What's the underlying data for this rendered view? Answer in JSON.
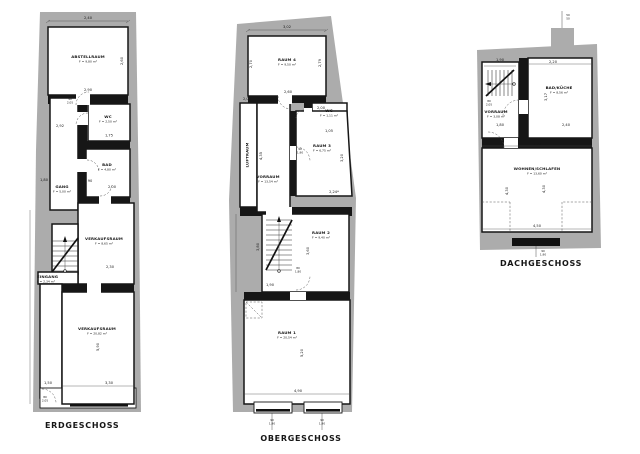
{
  "colors": {
    "wall_gray": "#acacac",
    "ink": "#161616",
    "background": "#ffffff"
  },
  "plans": {
    "eg": {
      "title": "ERDGESCHOSS",
      "rooms": {
        "abstellraum": {
          "name": "ABSTELLRAUM",
          "area": "F = 9,80 m²"
        },
        "wc": {
          "name": "WC",
          "area": "F = 2,50 m²"
        },
        "bad": {
          "name": "BAD",
          "area": "F = 4,80 m²"
        },
        "gang": {
          "name": "GANG",
          "area": "F = 5,00 m²"
        },
        "verkaufsraum_klein": {
          "name": "VERKAUFSRAUM",
          "area": "F = 8,65 m²"
        },
        "eingang": {
          "name": "EINGANG",
          "area": "F = 2,34 m²"
        },
        "verkaufsraum_gross": {
          "name": "VERKAUFSRAUM",
          "area": "F = 20,82 m²"
        }
      },
      "dims": [
        "2,40",
        "2,60",
        "2,90",
        "90",
        "2,05",
        "1,75",
        "2,92",
        "2,00",
        "1,80",
        "90",
        "2,30",
        "5,90",
        "3,30",
        "1,50",
        "80",
        "2,05"
      ]
    },
    "og": {
      "title": "OBERGESCHOSS",
      "rooms": {
        "raum4": {
          "name": "RAUM 4",
          "area": "F = 9,50 m²"
        },
        "wc": {
          "name": "WC",
          "area": "F = 1,11 m²"
        },
        "luftraum": {
          "name": "LUFTRAUM"
        },
        "raum3": {
          "name": "RAUM 3",
          "area": "F = 6,75 m²"
        },
        "vorraum": {
          "name": "VORRAUM",
          "area": "F = 13,54 m²"
        },
        "raum2": {
          "name": "RAUM 2",
          "area": "F = 9,40 m²"
        },
        "raum1": {
          "name": "RAUM 1",
          "area": "F = 20,54 m²"
        }
      },
      "dims": [
        "3,02",
        "2,70",
        "2,79",
        "2,60",
        "80",
        "2,05",
        "1,05",
        "2,06",
        "4,35",
        "2,00",
        "3,20",
        "2,24*",
        "90",
        "1,90",
        "3,80",
        "3,60",
        "80",
        "1,80",
        "1,90",
        "5,20",
        "4,90",
        "90",
        "1,90",
        "90",
        "1,90"
      ]
    },
    "dg": {
      "title": "DACHGESCHOSS",
      "rooms": {
        "bad_kueche": {
          "name": "BAD/KÜCHE",
          "area": "F = 8,56 m²"
        },
        "vorraum": {
          "name": "VORRAUM",
          "area": "F = 3,08 m²"
        },
        "wohnen_schlafen": {
          "name": "WOHNEN/SCHLAFEN",
          "area": "F = 13,60 m²"
        }
      },
      "dims": [
        "50",
        "50",
        "1,90",
        "2,20",
        "2,79",
        "3,17",
        "80",
        "2,05",
        "1,80",
        "2,40",
        "4,30",
        "4,30",
        "4,30",
        "4,50",
        "90",
        "1,90"
      ]
    }
  }
}
